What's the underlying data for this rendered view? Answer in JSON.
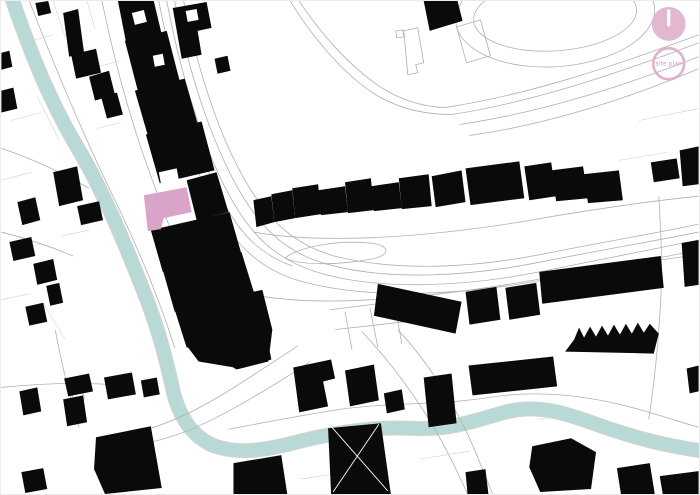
{
  "badge": {
    "label": "site plan"
  },
  "colors": {
    "background": "#ffffff",
    "building_black": "#0a0a0a",
    "river_teal": "#b9d9d6",
    "river_edge": "#ccd4d3",
    "street_gray": "#b0b0b0",
    "parcel_gray": "#d0d0d0",
    "highlight_pink": "#d9a4c7",
    "accent_pink": "#e2b7cf",
    "badge_ring_pink": "#e0b1cb",
    "badge_text_pink": "#d795bb"
  },
  "icons": {
    "north_indicator": "filled-pink-circle-with-white-tick",
    "site_plan_badge": "pink-ring-circle"
  }
}
